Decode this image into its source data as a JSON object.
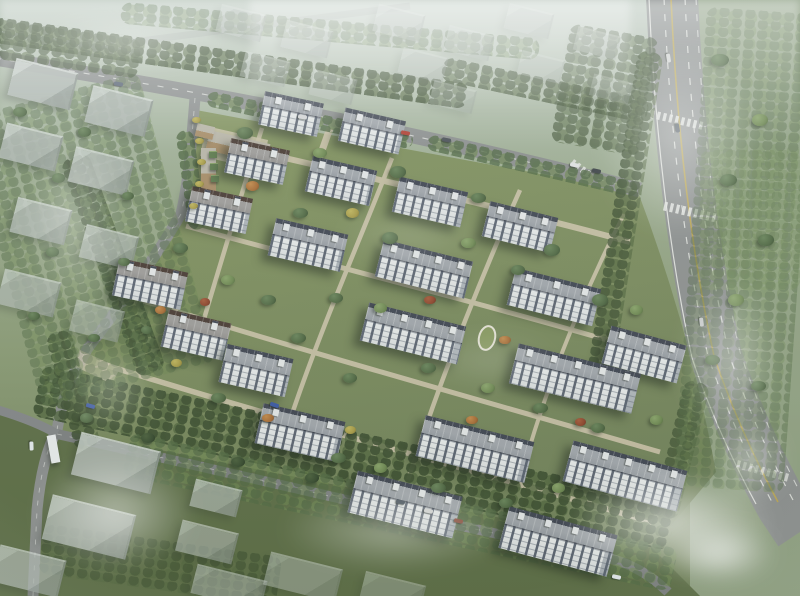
{
  "scene_type": "aerial-architectural-rendering-residential-compound",
  "palette": {
    "sky_haze": "#ffffff",
    "ground_top": "#c6d1c8",
    "ground_context": "#93a285",
    "ground_compound": "#7b8b60",
    "ground_bottom_dark": "#5d6d46",
    "park_green": "#95a487",
    "road_gray": "#8e9091",
    "road_dark": "#7e8082",
    "path_beige": "#cfc5ac",
    "lane_white": "#f2f2ef",
    "lane_yellow": "#c2a84e",
    "roof_light": "#a3a7ae",
    "roof_fascia_navy": "#3e4351",
    "roof_fascia_brown": "#483832",
    "facade_white": "#e8e9ea",
    "window_dark": "#59616f",
    "context_block": "#b3bab6",
    "tree_dark": "#36492e",
    "tree_mid": "#4f6742",
    "tree_light": "#6e8851",
    "tree_orange": "#a86a33",
    "tree_yellow": "#a89a44",
    "tree_red": "#8e4129",
    "commercial_tan": "#a98c66"
  },
  "residential_buildings_format": "[cx, cy, length, height, rotation_deg, roof_band]",
  "residential_buildings": [
    [
      291,
      114,
      60,
      34,
      12,
      "navy"
    ],
    [
      372,
      131,
      62,
      34,
      13,
      "navy"
    ],
    [
      257,
      161,
      60,
      35,
      12,
      "brown"
    ],
    [
      341,
      181,
      66,
      36,
      13,
      "navy"
    ],
    [
      430,
      202,
      70,
      36,
      13,
      "navy"
    ],
    [
      520,
      227,
      70,
      36,
      14,
      "navy"
    ],
    [
      219,
      210,
      62,
      36,
      12,
      "brown"
    ],
    [
      308,
      245,
      74,
      38,
      13,
      "navy"
    ],
    [
      424,
      269,
      92,
      38,
      14,
      "navy"
    ],
    [
      554,
      297,
      88,
      38,
      14,
      "navy"
    ],
    [
      150,
      284,
      70,
      38,
      12,
      "brown"
    ],
    [
      196,
      335,
      64,
      38,
      13,
      "brown"
    ],
    [
      256,
      370,
      68,
      39,
      13,
      "navy"
    ],
    [
      644,
      354,
      78,
      39,
      15,
      "navy"
    ],
    [
      575,
      378,
      126,
      41,
      14,
      "navy"
    ],
    [
      413,
      333,
      100,
      39,
      14,
      "navy"
    ],
    [
      300,
      432,
      84,
      41,
      13,
      "navy"
    ],
    [
      475,
      449,
      112,
      42,
      14,
      "navy"
    ],
    [
      625,
      476,
      118,
      42,
      15,
      "navy"
    ],
    [
      405,
      504,
      108,
      43,
      14,
      "navy"
    ],
    [
      558,
      541,
      112,
      43,
      15,
      "navy"
    ]
  ],
  "context_buildings_format": "[cx, cy, w, h, opacity]",
  "context_buildings": [
    [
      42,
      83,
      62,
      36,
      0.92
    ],
    [
      118,
      110,
      60,
      36,
      0.88
    ],
    [
      30,
      146,
      56,
      34,
      0.85
    ],
    [
      100,
      170,
      58,
      34,
      0.82
    ],
    [
      40,
      220,
      54,
      34,
      0.8
    ],
    [
      108,
      246,
      52,
      32,
      0.72
    ],
    [
      28,
      292,
      56,
      34,
      0.7
    ],
    [
      96,
      320,
      48,
      30,
      0.55
    ],
    [
      240,
      22,
      44,
      26,
      0.5
    ],
    [
      306,
      38,
      46,
      26,
      0.46
    ],
    [
      264,
      68,
      44,
      24,
      0.44
    ],
    [
      332,
      86,
      42,
      24,
      0.4
    ],
    [
      398,
      22,
      46,
      26,
      0.46
    ],
    [
      422,
      64,
      44,
      24,
      0.4
    ],
    [
      468,
      42,
      44,
      24,
      0.42
    ],
    [
      452,
      96,
      42,
      22,
      0.34
    ],
    [
      528,
      20,
      44,
      24,
      0.4
    ],
    [
      540,
      66,
      42,
      22,
      0.34
    ],
    [
      596,
      42,
      42,
      22,
      0.34
    ],
    [
      610,
      88,
      38,
      20,
      0.28
    ],
    [
      115,
      462,
      80,
      42,
      0.85
    ],
    [
      88,
      526,
      84,
      44,
      0.8
    ],
    [
      28,
      570,
      66,
      36,
      0.72
    ],
    [
      215,
      497,
      46,
      26,
      0.7
    ],
    [
      206,
      541,
      56,
      30,
      0.62
    ],
    [
      228,
      586,
      70,
      28,
      0.55
    ],
    [
      302,
      576,
      72,
      32,
      0.5
    ],
    [
      392,
      590,
      60,
      24,
      0.42
    ]
  ],
  "commercial_buildings_format": "[cx, cy, w, h, rotation_deg]",
  "commercial_buildings": [
    [
      238,
      147,
      62,
      20,
      13
    ],
    [
      208,
      171,
      15,
      46,
      0
    ],
    [
      205,
      131,
      18,
      13,
      13
    ]
  ],
  "kiosks_format": "[cx, cy]",
  "kiosks": [
    [
      213,
      154
    ],
    [
      214,
      166
    ],
    [
      215,
      178
    ]
  ],
  "gate_canopy": [
    53,
    449,
    9,
    28,
    -10
  ],
  "tree_strips_format": "[left, top, w, h, rotation_deg, variant, opacity]",
  "tree_strips": [
    [
      -10,
      50,
      480,
      26,
      8,
      "dark",
      0.9
    ],
    [
      120,
      20,
      420,
      22,
      5,
      "mid",
      0.55
    ],
    [
      440,
      78,
      210,
      24,
      12,
      "dark",
      0.75
    ],
    [
      205,
      112,
      210,
      16,
      12,
      "mid",
      0.9
    ],
    [
      425,
      158,
      215,
      16,
      13,
      "mid",
      0.85
    ],
    [
      98,
      150,
      30,
      230,
      -20,
      "dark",
      0.9
    ],
    [
      182,
      130,
      18,
      100,
      -8,
      "mid",
      0.9
    ],
    [
      60,
      330,
      26,
      120,
      -15,
      "dark",
      0.85
    ],
    [
      30,
      432,
      650,
      52,
      12,
      "dark",
      0.95
    ],
    [
      120,
      490,
      560,
      44,
      12,
      "mid",
      0.7
    ],
    [
      612,
      50,
      26,
      330,
      9,
      "dark",
      0.8
    ],
    [
      668,
      380,
      26,
      140,
      14,
      "dark",
      0.7
    ],
    [
      690,
      10,
      110,
      480,
      4,
      "mid",
      0.45
    ],
    [
      700,
      150,
      100,
      140,
      0,
      "light",
      0.35
    ],
    [
      0,
      90,
      180,
      300,
      -15,
      "mid",
      0.5
    ],
    [
      0,
      30,
      140,
      40,
      8,
      "dark",
      0.7
    ],
    [
      40,
      540,
      240,
      50,
      8,
      "dark",
      0.6
    ],
    [
      560,
      30,
      90,
      120,
      10,
      "dark",
      0.65
    ]
  ],
  "trees_format": "[cx, cy, size, variant]",
  "trees": [
    [
      245,
      133,
      16,
      "mid"
    ],
    [
      320,
      153,
      14,
      "light"
    ],
    [
      398,
      172,
      16,
      "mid"
    ],
    [
      478,
      198,
      15,
      "mid"
    ],
    [
      252,
      186,
      13,
      "orange"
    ],
    [
      300,
      213,
      15,
      "mid"
    ],
    [
      352,
      213,
      13,
      "yellow"
    ],
    [
      390,
      238,
      16,
      "mid"
    ],
    [
      468,
      243,
      15,
      "light"
    ],
    [
      552,
      250,
      16,
      "mid"
    ],
    [
      518,
      270,
      14,
      "mid"
    ],
    [
      600,
      300,
      16,
      "mid"
    ],
    [
      636,
      310,
      13,
      "light"
    ],
    [
      180,
      248,
      15,
      "mid"
    ],
    [
      228,
      280,
      14,
      "light"
    ],
    [
      268,
      300,
      15,
      "mid"
    ],
    [
      336,
      298,
      14,
      "mid"
    ],
    [
      380,
      308,
      13,
      "light"
    ],
    [
      430,
      300,
      12,
      "red"
    ],
    [
      298,
      338,
      15,
      "mid"
    ],
    [
      350,
      378,
      14,
      "mid"
    ],
    [
      428,
      368,
      15,
      "mid"
    ],
    [
      488,
      388,
      14,
      "light"
    ],
    [
      505,
      340,
      12,
      "orange"
    ],
    [
      540,
      408,
      15,
      "mid"
    ],
    [
      598,
      428,
      14,
      "mid"
    ],
    [
      656,
      420,
      13,
      "light"
    ],
    [
      580,
      422,
      11,
      "red"
    ],
    [
      218,
      398,
      15,
      "mid"
    ],
    [
      268,
      418,
      12,
      "orange"
    ],
    [
      338,
      458,
      15,
      "mid"
    ],
    [
      380,
      468,
      13,
      "light"
    ],
    [
      438,
      488,
      15,
      "mid"
    ],
    [
      506,
      503,
      14,
      "mid"
    ],
    [
      558,
      488,
      13,
      "light"
    ],
    [
      160,
      310,
      11,
      "orange"
    ],
    [
      176,
      363,
      11,
      "yellow"
    ],
    [
      205,
      302,
      10,
      "red"
    ],
    [
      350,
      430,
      11,
      "yellow"
    ],
    [
      472,
      420,
      12,
      "orange"
    ],
    [
      196,
      120,
      9,
      "yellow"
    ],
    [
      199,
      141,
      9,
      "yellow"
    ],
    [
      201,
      162,
      9,
      "yellow"
    ],
    [
      199,
      184,
      9,
      "yellow"
    ],
    [
      193,
      206,
      9,
      "yellow"
    ],
    [
      720,
      60,
      18,
      "mid"
    ],
    [
      760,
      120,
      16,
      "light"
    ],
    [
      728,
      180,
      17,
      "mid"
    ],
    [
      766,
      240,
      16,
      "mid"
    ],
    [
      736,
      300,
      16,
      "light"
    ],
    [
      712,
      360,
      15,
      "mid"
    ],
    [
      758,
      386,
      15,
      "mid"
    ],
    [
      86,
      418,
      13,
      "mid"
    ],
    [
      148,
      438,
      14,
      "dark"
    ],
    [
      238,
      462,
      14,
      "dark"
    ],
    [
      312,
      478,
      14,
      "dark"
    ],
    [
      20,
      112,
      14,
      "mid"
    ],
    [
      84,
      132,
      13,
      "mid"
    ],
    [
      58,
      178,
      13,
      "mid"
    ],
    [
      128,
      196,
      12,
      "mid"
    ],
    [
      52,
      252,
      13,
      "mid"
    ],
    [
      124,
      262,
      12,
      "mid"
    ],
    [
      34,
      316,
      12,
      "mid"
    ],
    [
      94,
      338,
      12,
      "mid"
    ],
    [
      146,
      330,
      11,
      "mid"
    ]
  ],
  "cars_format": "[cx, cy, rotation_deg, color]",
  "cars": [
    [
      405,
      133,
      11,
      "#b23a2e"
    ],
    [
      446,
      140,
      11,
      "#474c55"
    ],
    [
      302,
      117,
      10,
      "#d9dadb"
    ],
    [
      118,
      84,
      9,
      "#566074"
    ],
    [
      574,
      165,
      12,
      "#e6e7e8"
    ],
    [
      596,
      171,
      12,
      "#3c4147"
    ],
    [
      668,
      58,
      81,
      "#d8d8d8"
    ],
    [
      677,
      128,
      81,
      "#46505c"
    ],
    [
      701,
      322,
      83,
      "#cfd0d1"
    ],
    [
      90,
      406,
      16,
      "#3a57a6"
    ],
    [
      31,
      446,
      88,
      "#e8edf2"
    ],
    [
      274,
      405,
      18,
      "#3a57a6"
    ],
    [
      400,
      502,
      12,
      "#46505c"
    ],
    [
      428,
      511,
      12,
      "#d8d8d8"
    ],
    [
      458,
      521,
      13,
      "#8a4a3a"
    ],
    [
      616,
      577,
      12,
      "#e9eef3"
    ]
  ],
  "haze_patches_format": "[left, top, w, h, opacity, linear_flag]",
  "haze_patches": [
    [
      0,
      0,
      800,
      150,
      0.5,
      1
    ],
    [
      560,
      0,
      240,
      280,
      0.5,
      0
    ],
    [
      660,
      240,
      140,
      240,
      0.5,
      0
    ],
    [
      520,
      450,
      300,
      146,
      0.8,
      0
    ],
    [
      640,
      510,
      160,
      86,
      0.85,
      0
    ],
    [
      0,
      430,
      230,
      166,
      0.6,
      0
    ],
    [
      0,
      80,
      150,
      280,
      0.38,
      0
    ],
    [
      230,
      470,
      330,
      120,
      0.45,
      0
    ],
    [
      250,
      0,
      380,
      110,
      0.5,
      1
    ],
    [
      40,
      330,
      140,
      120,
      0.3,
      0
    ],
    [
      300,
      190,
      220,
      90,
      0.16,
      0
    ],
    [
      390,
      320,
      200,
      80,
      0.18,
      0
    ],
    [
      700,
      400,
      100,
      120,
      0.55,
      0
    ],
    [
      0,
      0,
      260,
      80,
      0.45,
      0
    ]
  ]
}
